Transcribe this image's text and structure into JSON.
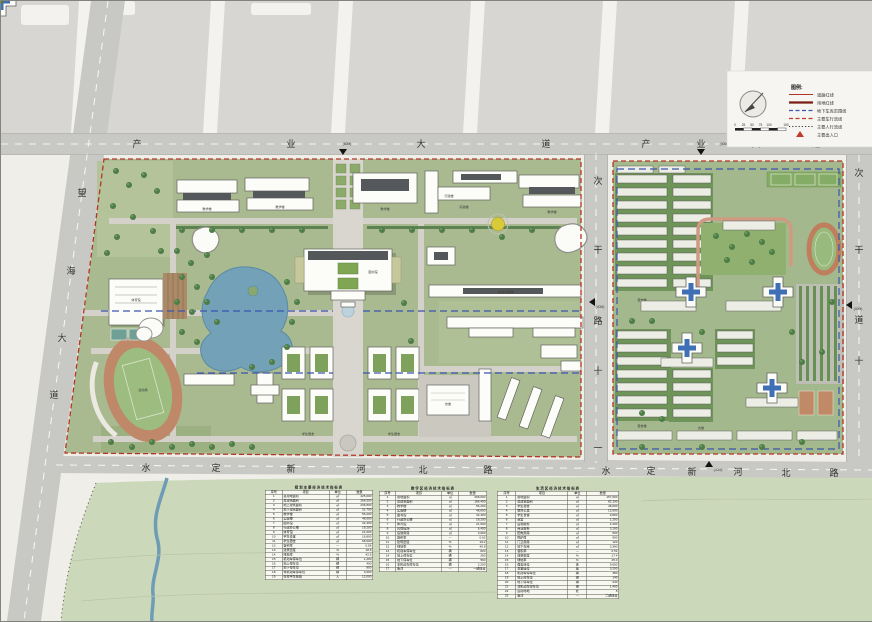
{
  "roads": {
    "top_left": {
      "chars": [
        "产",
        "业",
        "大",
        "道"
      ],
      "note": "(60M)"
    },
    "top_right": {
      "chars": [
        "产",
        "业",
        "大",
        "道"
      ],
      "note": "(60M)"
    },
    "left": {
      "chars": [
        "望",
        "海",
        "大",
        "道"
      ]
    },
    "bottom_left": {
      "chars": [
        "水",
        "定",
        "新",
        "河",
        "北",
        "路"
      ]
    },
    "bottom_right": {
      "chars": [
        "水",
        "定",
        "新",
        "河",
        "北",
        "路"
      ],
      "note": "(40M)"
    },
    "middle": {
      "chars": [
        "次",
        "干",
        "路",
        "十",
        "一"
      ],
      "note": "(40M)"
    },
    "right": {
      "chars": [
        "次",
        "干",
        "道",
        "十"
      ],
      "note": "(40M)"
    }
  },
  "legend": {
    "title": "图例:",
    "items": [
      {
        "label": "道路红线",
        "swatch": "line-red"
      },
      {
        "label": "用地红线",
        "swatch": "line-darkred"
      },
      {
        "label": "地下车库范围线",
        "swatch": "dash-blue"
      },
      {
        "label": "主要车行流线",
        "swatch": "dash-red"
      },
      {
        "label": "主要人行流线",
        "swatch": "dot-black"
      },
      {
        "label": "主要出入口",
        "swatch": "triangle-red"
      }
    ],
    "scale_ticks": [
      "0",
      "25",
      "50",
      "75",
      "100",
      "150"
    ]
  },
  "labels": {
    "teaching1": "教学楼",
    "teaching2": "教学楼",
    "teaching3": "教学楼",
    "lab_top": "实验楼",
    "teaching4": "教学楼",
    "admin": "行政楼",
    "library": "图书馆",
    "complex_lab": "综合实验楼",
    "gym": "体育馆",
    "stadium": "运动场",
    "canteen": "食堂",
    "dorm_a": "学生宿舍",
    "dorm_b": "学生宿舍",
    "dorm_r1": "宿舍楼",
    "dorm_r2": "宿舍楼",
    "canteen_r": "食堂"
  },
  "tables": [
    {
      "title": "规划主要经济技术指标表",
      "headers": [
        "序号",
        "项目",
        "单位",
        "数量"
      ],
      "rows": [
        [
          "1",
          "总用地面积",
          "㎡",
          "425,000"
        ],
        [
          "2",
          "总建筑面积",
          "㎡",
          "268,500"
        ],
        [
          "3",
          "地上建筑面积",
          "㎡",
          "236,800"
        ],
        [
          "4",
          "地下建筑面积",
          "㎡",
          "31,700"
        ],
        [
          "5",
          "教学楼",
          "㎡",
          "56,200"
        ],
        [
          "6",
          "实验楼",
          "㎡",
          "48,600"
        ],
        [
          "7",
          "图书馆",
          "㎡",
          "32,400"
        ],
        [
          "8",
          "行政办公楼",
          "㎡",
          "18,200"
        ],
        [
          "9",
          "体育馆",
          "㎡",
          "21,600"
        ],
        [
          "10",
          "学生食堂",
          "㎡",
          "16,800"
        ],
        [
          "11",
          "学生宿舍",
          "㎡",
          "68,000"
        ],
        [
          "12",
          "容积率",
          "—",
          "0.56"
        ],
        [
          "13",
          "建筑密度",
          "%",
          "18.6"
        ],
        [
          "14",
          "绿地率",
          "%",
          "42.5"
        ],
        [
          "15",
          "机动车停车位",
          "辆",
          "1,200"
        ],
        [
          "16",
          "地上停车位",
          "辆",
          "400"
        ],
        [
          "17",
          "地下停车位",
          "辆",
          "800"
        ],
        [
          "18",
          "非机动车停车位",
          "辆",
          "3,600"
        ],
        [
          "19",
          "在校学生规模",
          "人",
          "12,000"
        ]
      ]
    },
    {
      "title": "教学区经济技术指标表",
      "headers": [
        "序号",
        "项目",
        "单位",
        "数量"
      ],
      "rows": [
        [
          "1",
          "用地面积",
          "㎡",
          "268,000"
        ],
        [
          "2",
          "总建筑面积",
          "㎡",
          "186,400"
        ],
        [
          "3",
          "教学楼",
          "㎡",
          "56,200"
        ],
        [
          "4",
          "实验楼",
          "㎡",
          "48,600"
        ],
        [
          "5",
          "图书馆",
          "㎡",
          "32,400"
        ],
        [
          "6",
          "行政办公楼",
          "㎡",
          "18,200"
        ],
        [
          "7",
          "体育馆",
          "㎡",
          "21,600"
        ],
        [
          "8",
          "风雨操场",
          "㎡",
          "6,400"
        ],
        [
          "9",
          "后勤用房",
          "㎡",
          "3,000"
        ],
        [
          "10",
          "容积率",
          "—",
          "0.62"
        ],
        [
          "11",
          "建筑密度",
          "%",
          "19.2"
        ],
        [
          "12",
          "绿地率",
          "%",
          "40.8"
        ],
        [
          "13",
          "机动车停车位",
          "辆",
          "820"
        ],
        [
          "14",
          "地上停车位",
          "辆",
          "260"
        ],
        [
          "15",
          "地下停车位",
          "辆",
          "560"
        ],
        [
          "16",
          "非机动车停车位",
          "辆",
          "2,200"
        ],
        [
          "17",
          "备注",
          "—",
          "一期建设"
        ]
      ]
    },
    {
      "title": "生活区经济技术指标表",
      "headers": [
        "序号",
        "项目",
        "单位",
        "数量"
      ],
      "rows": [
        [
          "1",
          "用地面积",
          "㎡",
          "157,000"
        ],
        [
          "2",
          "总建筑面积",
          "㎡",
          "82,100"
        ],
        [
          "3",
          "学生宿舍",
          "㎡",
          "48,000"
        ],
        [
          "4",
          "教师公寓",
          "㎡",
          "12,600"
        ],
        [
          "5",
          "学生食堂",
          "㎡",
          "9,800"
        ],
        [
          "6",
          "浴室",
          "㎡",
          "1,200"
        ],
        [
          "7",
          "后勤服务",
          "㎡",
          "2,400"
        ],
        [
          "8",
          "商业服务",
          "㎡",
          "3,100"
        ],
        [
          "9",
          "配电用房",
          "㎡",
          "600"
        ],
        [
          "10",
          "锅炉房",
          "㎡",
          "900"
        ],
        [
          "11",
          "门卫用房",
          "㎡",
          "120"
        ],
        [
          "12",
          "地下车库",
          "㎡",
          "3,380"
        ],
        [
          "13",
          "容积率",
          "—",
          "0.52"
        ],
        [
          "14",
          "建筑密度",
          "%",
          "17.4"
        ],
        [
          "15",
          "绿地率",
          "%",
          "45.0"
        ],
        [
          "16",
          "宿舍床位",
          "床",
          "9,600"
        ],
        [
          "17",
          "食堂座位",
          "座",
          "3,200"
        ],
        [
          "18",
          "机动车停车位",
          "辆",
          "380"
        ],
        [
          "19",
          "地上停车位",
          "辆",
          "140"
        ],
        [
          "20",
          "地下停车位",
          "辆",
          "240"
        ],
        [
          "21",
          "非机动车停车位",
          "辆",
          "1,400"
        ],
        [
          "22",
          "运动场地",
          "处",
          "6"
        ],
        [
          "23",
          "备注",
          "—",
          "二期建设"
        ]
      ]
    }
  ]
}
